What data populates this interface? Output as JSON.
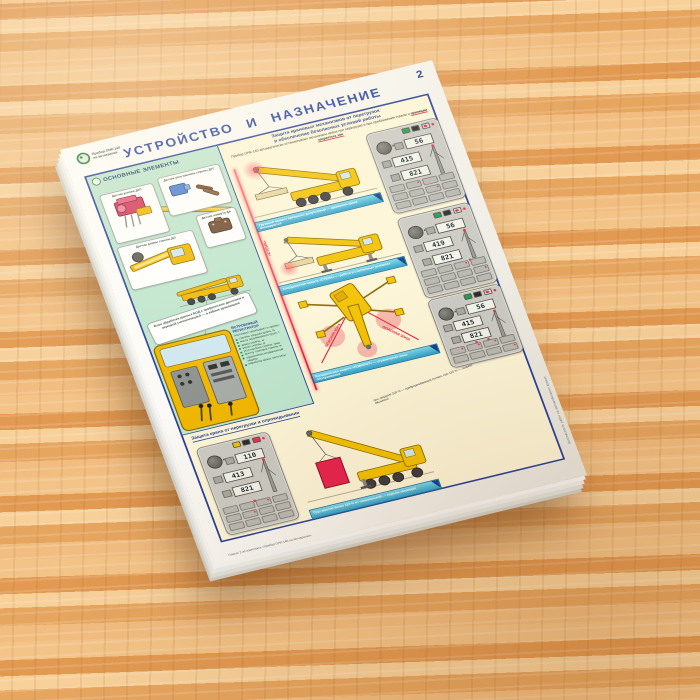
{
  "surface": {
    "type": "wooden table"
  },
  "poster": {
    "page_number": "2",
    "title": "УСТРОЙСТВО И НАЗНАЧЕНИЕ",
    "brand": {
      "line1": "Прибор ОНК-140",
      "line2": "на автокранах"
    },
    "colors": {
      "accent_blue": "#27409b",
      "panel_green": "#bfe6cf",
      "panel_cream": "#fdf6d8",
      "alarm_red": "#e8304a",
      "crane_yellow": "#f3c200",
      "caption_cyan": "#45bfdd"
    },
    "left_panel": {
      "title": "ОСНОВНЫЕ ЭЛЕМЕНТЫ",
      "captions": {
        "dus": "Датчик усилия ДУС",
        "dug": "Датчик угла наклона стрелы ДУГ",
        "da": "Датчик азимута ДА",
        "dl": "Датчик длины стрелы ДЛ"
      },
      "bod_callout": "Блок обработки данных БОД с графическим дисплеем и звуковой сигнализацией — в кабине крановщика",
      "registrator": {
        "title": "ВСТРОЕННЫЙ РЕГИСТРАТОР",
        "intro": "постоянно записывает и хранит:",
        "items": [
          "степень загрузки крана, %",
          "массу поднимаемого груза, т",
          "длину стрелы, м",
          "вылет стрелы, м",
          "угол наклона стрелы, град",
          "высоту оголовка стрелы, м",
          "ограничения координатной защиты",
          "наработку крана, моточасы"
        ]
      }
    },
    "right_panel": {
      "header_line1": "Защита крановых механизмов от перегрузок",
      "header_line2": "и обеспечение безопасных условий работы",
      "intro_text": "Прибор ОНК-140 автоматически останавливает механизмы крана при перегрузке и при приближении стрелы к",
      "intro_highlight": "границам запретных зон",
      "captions": {
        "overload": "Грузовой момент превысил допустимый — движения крана блокируются",
        "wall": "Координатная защита «СТЕНА» — работа в стеснённых условиях",
        "turn": "Координатная защита «ПОВОРОТ» — ограничение зоны обслуживания",
        "load": "Груз массой более 110 % от номинальной — подъём запрещён"
      },
      "labels": {
        "wall": "«СТЕНА»",
        "zone1": "ОПАСНАЯ ЗОНА",
        "zone2": "ОПАСНАЯ ЗОНА"
      },
      "bottom_header": "Защита крана от перегрузки и опрокидывания",
      "bottom_note": "при загрузке 105 % — предупреждающий сигнал, при 110 % — запрет движений",
      "panels": [
        {
          "d1": "56",
          "d2": "415",
          "d3": "821"
        },
        {
          "d1": "56",
          "d2": "419",
          "d3": "821"
        },
        {
          "d1": "56",
          "d2": "415",
          "d3": "821"
        },
        {
          "d1": "110",
          "d2": "413",
          "d3": "821"
        }
      ]
    },
    "footer": {
      "credits_line1": "Плакат 2 из комплекта «Прибор ОНК-140 на автокранах»",
      "side_text": "Безопасность работ на автомобильных кранах"
    }
  }
}
